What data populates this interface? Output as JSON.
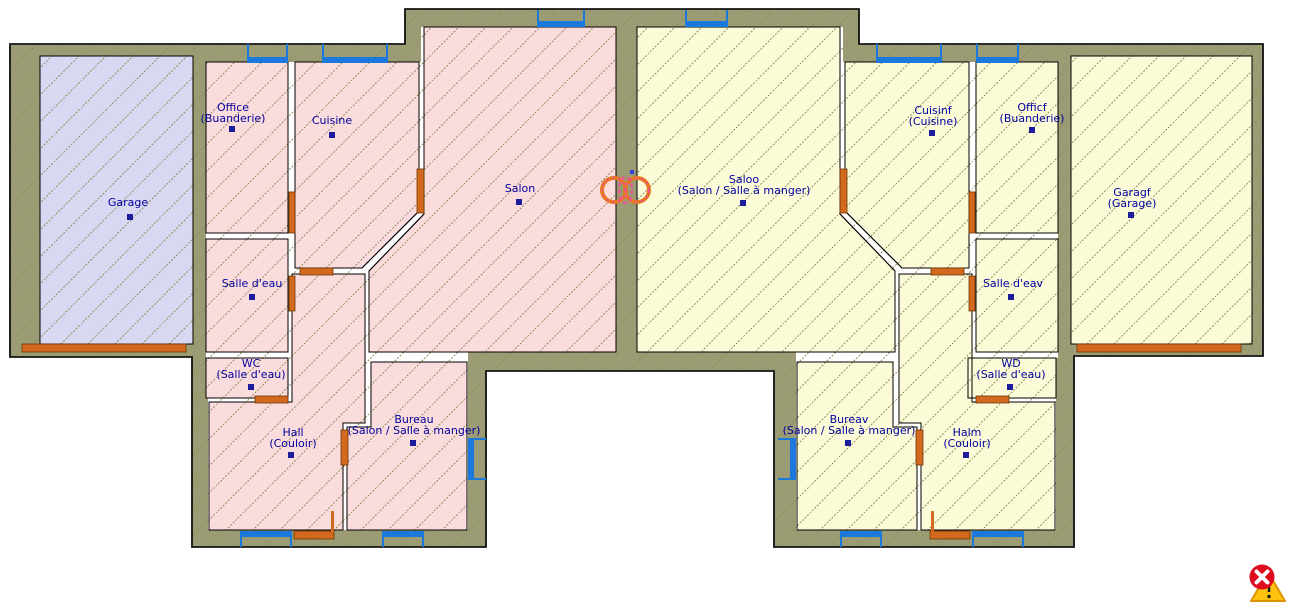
{
  "canvas": {
    "width": 1289,
    "height": 603,
    "background": "#FFFFFF"
  },
  "colors": {
    "wall_fill": "#9C9C74",
    "wall_stroke": "#141414",
    "interior_fill": "#FFFFFF",
    "room_stroke": "#000000",
    "hatch_line": "#8E8E5E",
    "pink_room": "#FBDCDC",
    "yellow_room": "#FBFBD8",
    "lavender_room": "#D8D8F2",
    "window_blue": "#1B78DC",
    "door_orange": "#D2691E",
    "door_edge": "#703800",
    "label_navy": "#00009E",
    "marker_navy": "#1C1C9C",
    "symbol_orange": "#E87A1E",
    "symbol_pink": "#EE4E9B",
    "cursor_red": "#DF0A1E",
    "cursor_yellow": "#FFC20E",
    "cursor_yellow_edge": "#DE9400"
  },
  "floorplan": {
    "footprint": [
      [
        10,
        44
      ],
      [
        405,
        44
      ],
      [
        405,
        9
      ],
      [
        859,
        9
      ],
      [
        859,
        44
      ],
      [
        1263,
        44
      ],
      [
        1263,
        356
      ],
      [
        1074,
        356
      ],
      [
        1074,
        547
      ],
      [
        774,
        547
      ],
      [
        774,
        371
      ],
      [
        486,
        371
      ],
      [
        486,
        547
      ],
      [
        192,
        547
      ],
      [
        192,
        357
      ],
      [
        10,
        357
      ]
    ],
    "interiors": [
      [
        [
          206,
          62
        ],
        [
          421,
          62
        ],
        [
          421,
          27
        ],
        [
          616,
          27
        ],
        [
          616,
          352
        ],
        [
          468,
          352
        ],
        [
          468,
          530
        ],
        [
          208,
          530
        ],
        [
          208,
          358
        ],
        [
          206,
          358
        ]
      ],
      [
        [
          1058,
          62
        ],
        [
          843,
          62
        ],
        [
          843,
          27
        ],
        [
          637,
          27
        ],
        [
          637,
          352
        ],
        [
          796,
          352
        ],
        [
          796,
          530
        ],
        [
          1056,
          530
        ],
        [
          1056,
          358
        ],
        [
          1058,
          358
        ]
      ]
    ],
    "rooms": [
      {
        "id": "garage",
        "label": "Garage",
        "label2": "",
        "fill": "lavender_room",
        "poly": [
          [
            40,
            56
          ],
          [
            193,
            56
          ],
          [
            193,
            344
          ],
          [
            40,
            344
          ]
        ],
        "lx": 128,
        "ly": 206,
        "mx": 130,
        "my": 214
      },
      {
        "id": "office",
        "label": "Office",
        "label2": "(Buanderie)",
        "fill": "pink_room",
        "poly": [
          [
            206,
            62
          ],
          [
            288,
            62
          ],
          [
            288,
            233
          ],
          [
            206,
            233
          ]
        ],
        "lx": 233,
        "ly": 111,
        "mx": 232,
        "my": 126
      },
      {
        "id": "cuisine",
        "label": "Cuisine",
        "label2": "",
        "fill": "pink_room",
        "poly": [
          [
            295,
            62
          ],
          [
            419,
            62
          ],
          [
            419,
            211
          ],
          [
            362,
            268
          ],
          [
            295,
            268
          ]
        ],
        "lx": 332,
        "ly": 124,
        "mx": 332,
        "my": 132
      },
      {
        "id": "salle-deau",
        "label": "Salle d'eau",
        "label2": "",
        "fill": "pink_room",
        "poly": [
          [
            206,
            239
          ],
          [
            288,
            239
          ],
          [
            288,
            352
          ],
          [
            206,
            352
          ]
        ],
        "lx": 252,
        "ly": 287,
        "mx": 252,
        "my": 294
      },
      {
        "id": "wc",
        "label": "WC",
        "label2": "(Salle d'eau)",
        "fill": "pink_room",
        "poly": [
          [
            206,
            358
          ],
          [
            288,
            358
          ],
          [
            288,
            398
          ],
          [
            206,
            398
          ]
        ],
        "lx": 251,
        "ly": 367,
        "mx": 251,
        "my": 384
      },
      {
        "id": "salon",
        "label": "Salon",
        "label2": "",
        "fill": "pink_room",
        "poly": [
          [
            424,
            27
          ],
          [
            616,
            27
          ],
          [
            616,
            352
          ],
          [
            369,
            352
          ],
          [
            369,
            271
          ],
          [
            424,
            214
          ]
        ],
        "lx": 520,
        "ly": 192,
        "mx": 519,
        "my": 199
      },
      {
        "id": "hall",
        "label": "Hall",
        "label2": "(Couloir)",
        "fill": "pink_room",
        "poly": [
          [
            292,
            274
          ],
          [
            365,
            274
          ],
          [
            365,
            423
          ],
          [
            343,
            423
          ],
          [
            343,
            530
          ],
          [
            209,
            530
          ],
          [
            209,
            402
          ],
          [
            292,
            402
          ]
        ],
        "lx": 293,
        "ly": 436,
        "mx": 291,
        "my": 452
      },
      {
        "id": "bureau",
        "label": "Bureau",
        "label2": "(Salon / Salle à manger)",
        "fill": "pink_room",
        "poly": [
          [
            371,
            362
          ],
          [
            467,
            362
          ],
          [
            467,
            530
          ],
          [
            347,
            530
          ],
          [
            347,
            427
          ],
          [
            371,
            427
          ]
        ],
        "lx": 414,
        "ly": 423,
        "mx": 413,
        "my": 440
      },
      {
        "id": "saloo",
        "label": "Saloo",
        "label2": "(Salon / Salle à manger)",
        "fill": "yellow_room",
        "poly": [
          [
            840,
            27
          ],
          [
            637,
            27
          ],
          [
            637,
            352
          ],
          [
            895,
            352
          ],
          [
            895,
            271
          ],
          [
            840,
            214
          ]
        ],
        "lx": 744,
        "ly": 183,
        "mx": 743,
        "my": 200
      },
      {
        "id": "cuisinf",
        "label": "Cuisinf",
        "label2": "(Cuisine)",
        "fill": "yellow_room",
        "poly": [
          [
            969,
            62
          ],
          [
            845,
            62
          ],
          [
            845,
            211
          ],
          [
            902,
            268
          ],
          [
            969,
            268
          ]
        ],
        "lx": 933,
        "ly": 114,
        "mx": 932,
        "my": 130
      },
      {
        "id": "officf",
        "label": "Officf",
        "label2": "(Buanderie)",
        "fill": "yellow_room",
        "poly": [
          [
            976,
            62
          ],
          [
            1058,
            62
          ],
          [
            1058,
            233
          ],
          [
            976,
            233
          ]
        ],
        "lx": 1032,
        "ly": 111,
        "mx": 1032,
        "my": 127
      },
      {
        "id": "salle-deav",
        "label": "Salle d'eav",
        "label2": "",
        "fill": "yellow_room",
        "poly": [
          [
            976,
            239
          ],
          [
            1058,
            239
          ],
          [
            1058,
            352
          ],
          [
            976,
            352
          ]
        ],
        "lx": 1013,
        "ly": 287,
        "mx": 1011,
        "my": 294
      },
      {
        "id": "wd",
        "label": "WD",
        "label2": "(Salle d'eau)",
        "fill": "yellow_room",
        "poly": [
          [
            968,
            358
          ],
          [
            1056,
            358
          ],
          [
            1056,
            398
          ],
          [
            968,
            398
          ]
        ],
        "lx": 1011,
        "ly": 367,
        "mx": 1010,
        "my": 384
      },
      {
        "id": "garagf",
        "label": "Garagf",
        "label2": "(Garage)",
        "fill": "yellow_room",
        "poly": [
          [
            1071,
            56
          ],
          [
            1252,
            56
          ],
          [
            1252,
            344
          ],
          [
            1071,
            344
          ]
        ],
        "lx": 1132,
        "ly": 196,
        "mx": 1131,
        "my": 212
      },
      {
        "id": "bureav",
        "label": "Bureav",
        "label2": "(Salon / Salle à manger)",
        "fill": "yellow_room",
        "poly": [
          [
            893,
            362
          ],
          [
            797,
            362
          ],
          [
            797,
            530
          ],
          [
            917,
            530
          ],
          [
            917,
            427
          ],
          [
            893,
            427
          ]
        ],
        "lx": 849,
        "ly": 423,
        "mx": 848,
        "my": 440
      },
      {
        "id": "halm",
        "label": "Halm",
        "label2": "(Couloir)",
        "fill": "yellow_room",
        "poly": [
          [
            972,
            274
          ],
          [
            899,
            274
          ],
          [
            899,
            423
          ],
          [
            921,
            423
          ],
          [
            921,
            530
          ],
          [
            1055,
            530
          ],
          [
            1055,
            402
          ],
          [
            972,
            402
          ]
        ],
        "lx": 967,
        "ly": 436,
        "mx": 966,
        "my": 452
      }
    ],
    "windows": [
      {
        "id": "win-proj-left",
        "x": 537,
        "y": 10,
        "w": 48,
        "h": 17,
        "edge": "top"
      },
      {
        "id": "win-office-top",
        "x": 247,
        "y": 44,
        "w": 41,
        "h": 19,
        "edge": "top"
      },
      {
        "id": "win-cuisine-top",
        "x": 322,
        "y": 44,
        "w": 66,
        "h": 19,
        "edge": "top"
      },
      {
        "id": "win-hall-bottom",
        "x": 240,
        "y": 531,
        "w": 52,
        "h": 16,
        "edge": "bottom"
      },
      {
        "id": "win-bureau-bottom",
        "x": 382,
        "y": 531,
        "w": 42,
        "h": 16,
        "edge": "bottom"
      },
      {
        "id": "win-bureau-east",
        "x": 468,
        "y": 438,
        "w": 18,
        "h": 42,
        "edge": "right"
      },
      {
        "id": "win-proj-right",
        "x": 685,
        "y": 10,
        "w": 43,
        "h": 17,
        "edge": "top"
      },
      {
        "id": "win-cuisinf-top",
        "x": 876,
        "y": 44,
        "w": 66,
        "h": 19,
        "edge": "top"
      },
      {
        "id": "win-officf-top",
        "x": 976,
        "y": 44,
        "w": 43,
        "h": 19,
        "edge": "top"
      },
      {
        "id": "win-bureav-west",
        "x": 778,
        "y": 438,
        "w": 18,
        "h": 42,
        "edge": "left"
      },
      {
        "id": "win-bureav-bottom",
        "x": 840,
        "y": 531,
        "w": 42,
        "h": 16,
        "edge": "bottom"
      },
      {
        "id": "win-halm-bottom",
        "x": 972,
        "y": 531,
        "w": 52,
        "h": 16,
        "edge": "bottom"
      }
    ],
    "doors": [
      {
        "id": "door-garage",
        "x": 22,
        "y": 344,
        "w": 164,
        "h": 8
      },
      {
        "id": "door-office",
        "x": 289,
        "y": 192,
        "w": 6,
        "h": 41
      },
      {
        "id": "door-salle-deau",
        "x": 289,
        "y": 276,
        "w": 6,
        "h": 35
      },
      {
        "id": "door-cuisine-south",
        "x": 300,
        "y": 268,
        "w": 33,
        "h": 7
      },
      {
        "id": "door-cuisine-east",
        "x": 417,
        "y": 169,
        "w": 7,
        "h": 44
      },
      {
        "id": "door-wc",
        "x": 255,
        "y": 396,
        "w": 33,
        "h": 7
      },
      {
        "id": "door-hall-bureau",
        "x": 341,
        "y": 430,
        "w": 7,
        "h": 35
      },
      {
        "id": "door-entrance-left",
        "x": 294,
        "y": 531,
        "w": 40,
        "h": 8
      },
      {
        "id": "door-garagf",
        "x": 1077,
        "y": 344,
        "w": 164,
        "h": 8
      },
      {
        "id": "door-officf",
        "x": 969,
        "y": 192,
        "w": 6,
        "h": 41
      },
      {
        "id": "door-salle-deav",
        "x": 969,
        "y": 276,
        "w": 6,
        "h": 35
      },
      {
        "id": "door-cuisinf-south",
        "x": 931,
        "y": 268,
        "w": 33,
        "h": 7
      },
      {
        "id": "door-cuisinf-west",
        "x": 840,
        "y": 169,
        "w": 7,
        "h": 44
      },
      {
        "id": "door-wd",
        "x": 976,
        "y": 396,
        "w": 33,
        "h": 7
      },
      {
        "id": "door-halm-bureav",
        "x": 916,
        "y": 430,
        "w": 7,
        "h": 35
      },
      {
        "id": "door-entrance-right",
        "x": 930,
        "y": 531,
        "w": 40,
        "h": 8
      }
    ],
    "door_ticks": [
      {
        "x": 331,
        "y": 511,
        "w": 3,
        "h": 21
      },
      {
        "x": 931,
        "y": 511,
        "w": 3,
        "h": 21
      }
    ],
    "selection_symbol": {
      "circles": [
        [
          614,
          190,
          12
        ],
        [
          637,
          190,
          12
        ]
      ],
      "ellipse": [
        625.5,
        190,
        6.5,
        13
      ],
      "dot": [
        630,
        170,
        4,
        4
      ]
    },
    "cursor": {
      "triangle": [
        [
          1251,
          601
        ],
        [
          1285,
          601
        ],
        [
          1268,
          572
        ]
      ],
      "excl_line": [
        1269,
        581,
        1269,
        592
      ],
      "excl_dot": [
        1269,
        596.5,
        1.7
      ],
      "circle": [
        1262,
        577,
        12.5
      ],
      "x_lines": [
        [
          1256.5,
          571.5,
          1267.5,
          582.5
        ],
        [
          1267.5,
          571.5,
          1256.5,
          582.5
        ]
      ]
    },
    "hatch": {
      "size": 27,
      "dash": "2,1.5",
      "width": 1
    }
  }
}
